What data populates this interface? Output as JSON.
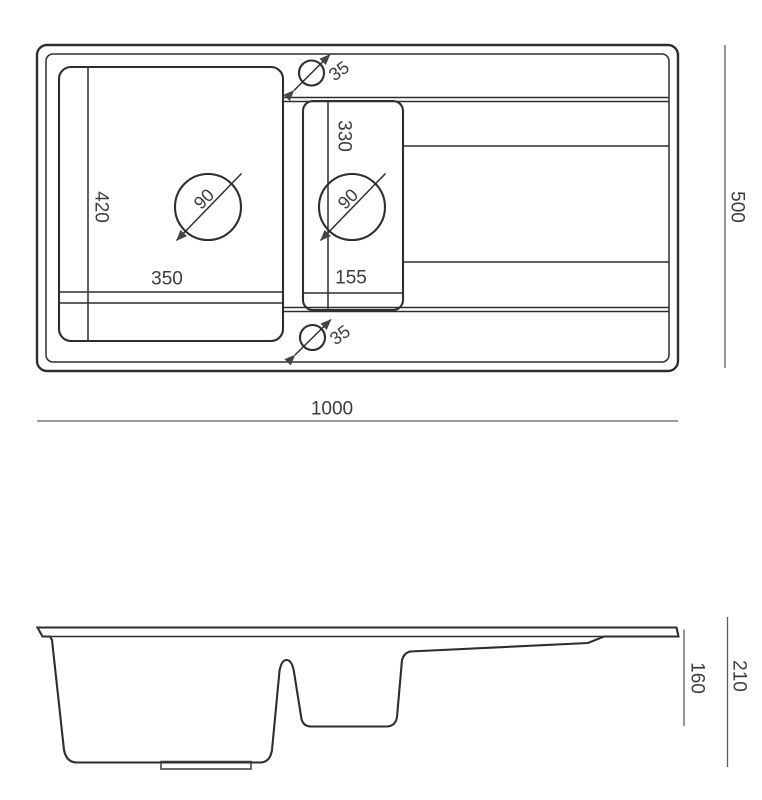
{
  "colors": {
    "outline": "#2e2e2e",
    "inner_line": "#3a3a3a",
    "dimension_line": "#5f5f5f",
    "text": "#3c3c3c",
    "drain_recess_fill": "#8e8e8e",
    "background": "#ffffff"
  },
  "top_view": {
    "overall_width_mm": "1000",
    "overall_depth_mm": "500",
    "main_bowl": {
      "width_mm": "350",
      "depth_mm": "420",
      "drain_diameter_mm": "90"
    },
    "second_bowl": {
      "width_mm": "155",
      "depth_mm": "330",
      "drain_diameter_mm": "90"
    },
    "tap_holes": {
      "top_diameter_mm": "35",
      "bottom_diameter_mm": "35"
    }
  },
  "side_view": {
    "bowl_depth_mm": "160",
    "overall_height_mm": "210"
  }
}
